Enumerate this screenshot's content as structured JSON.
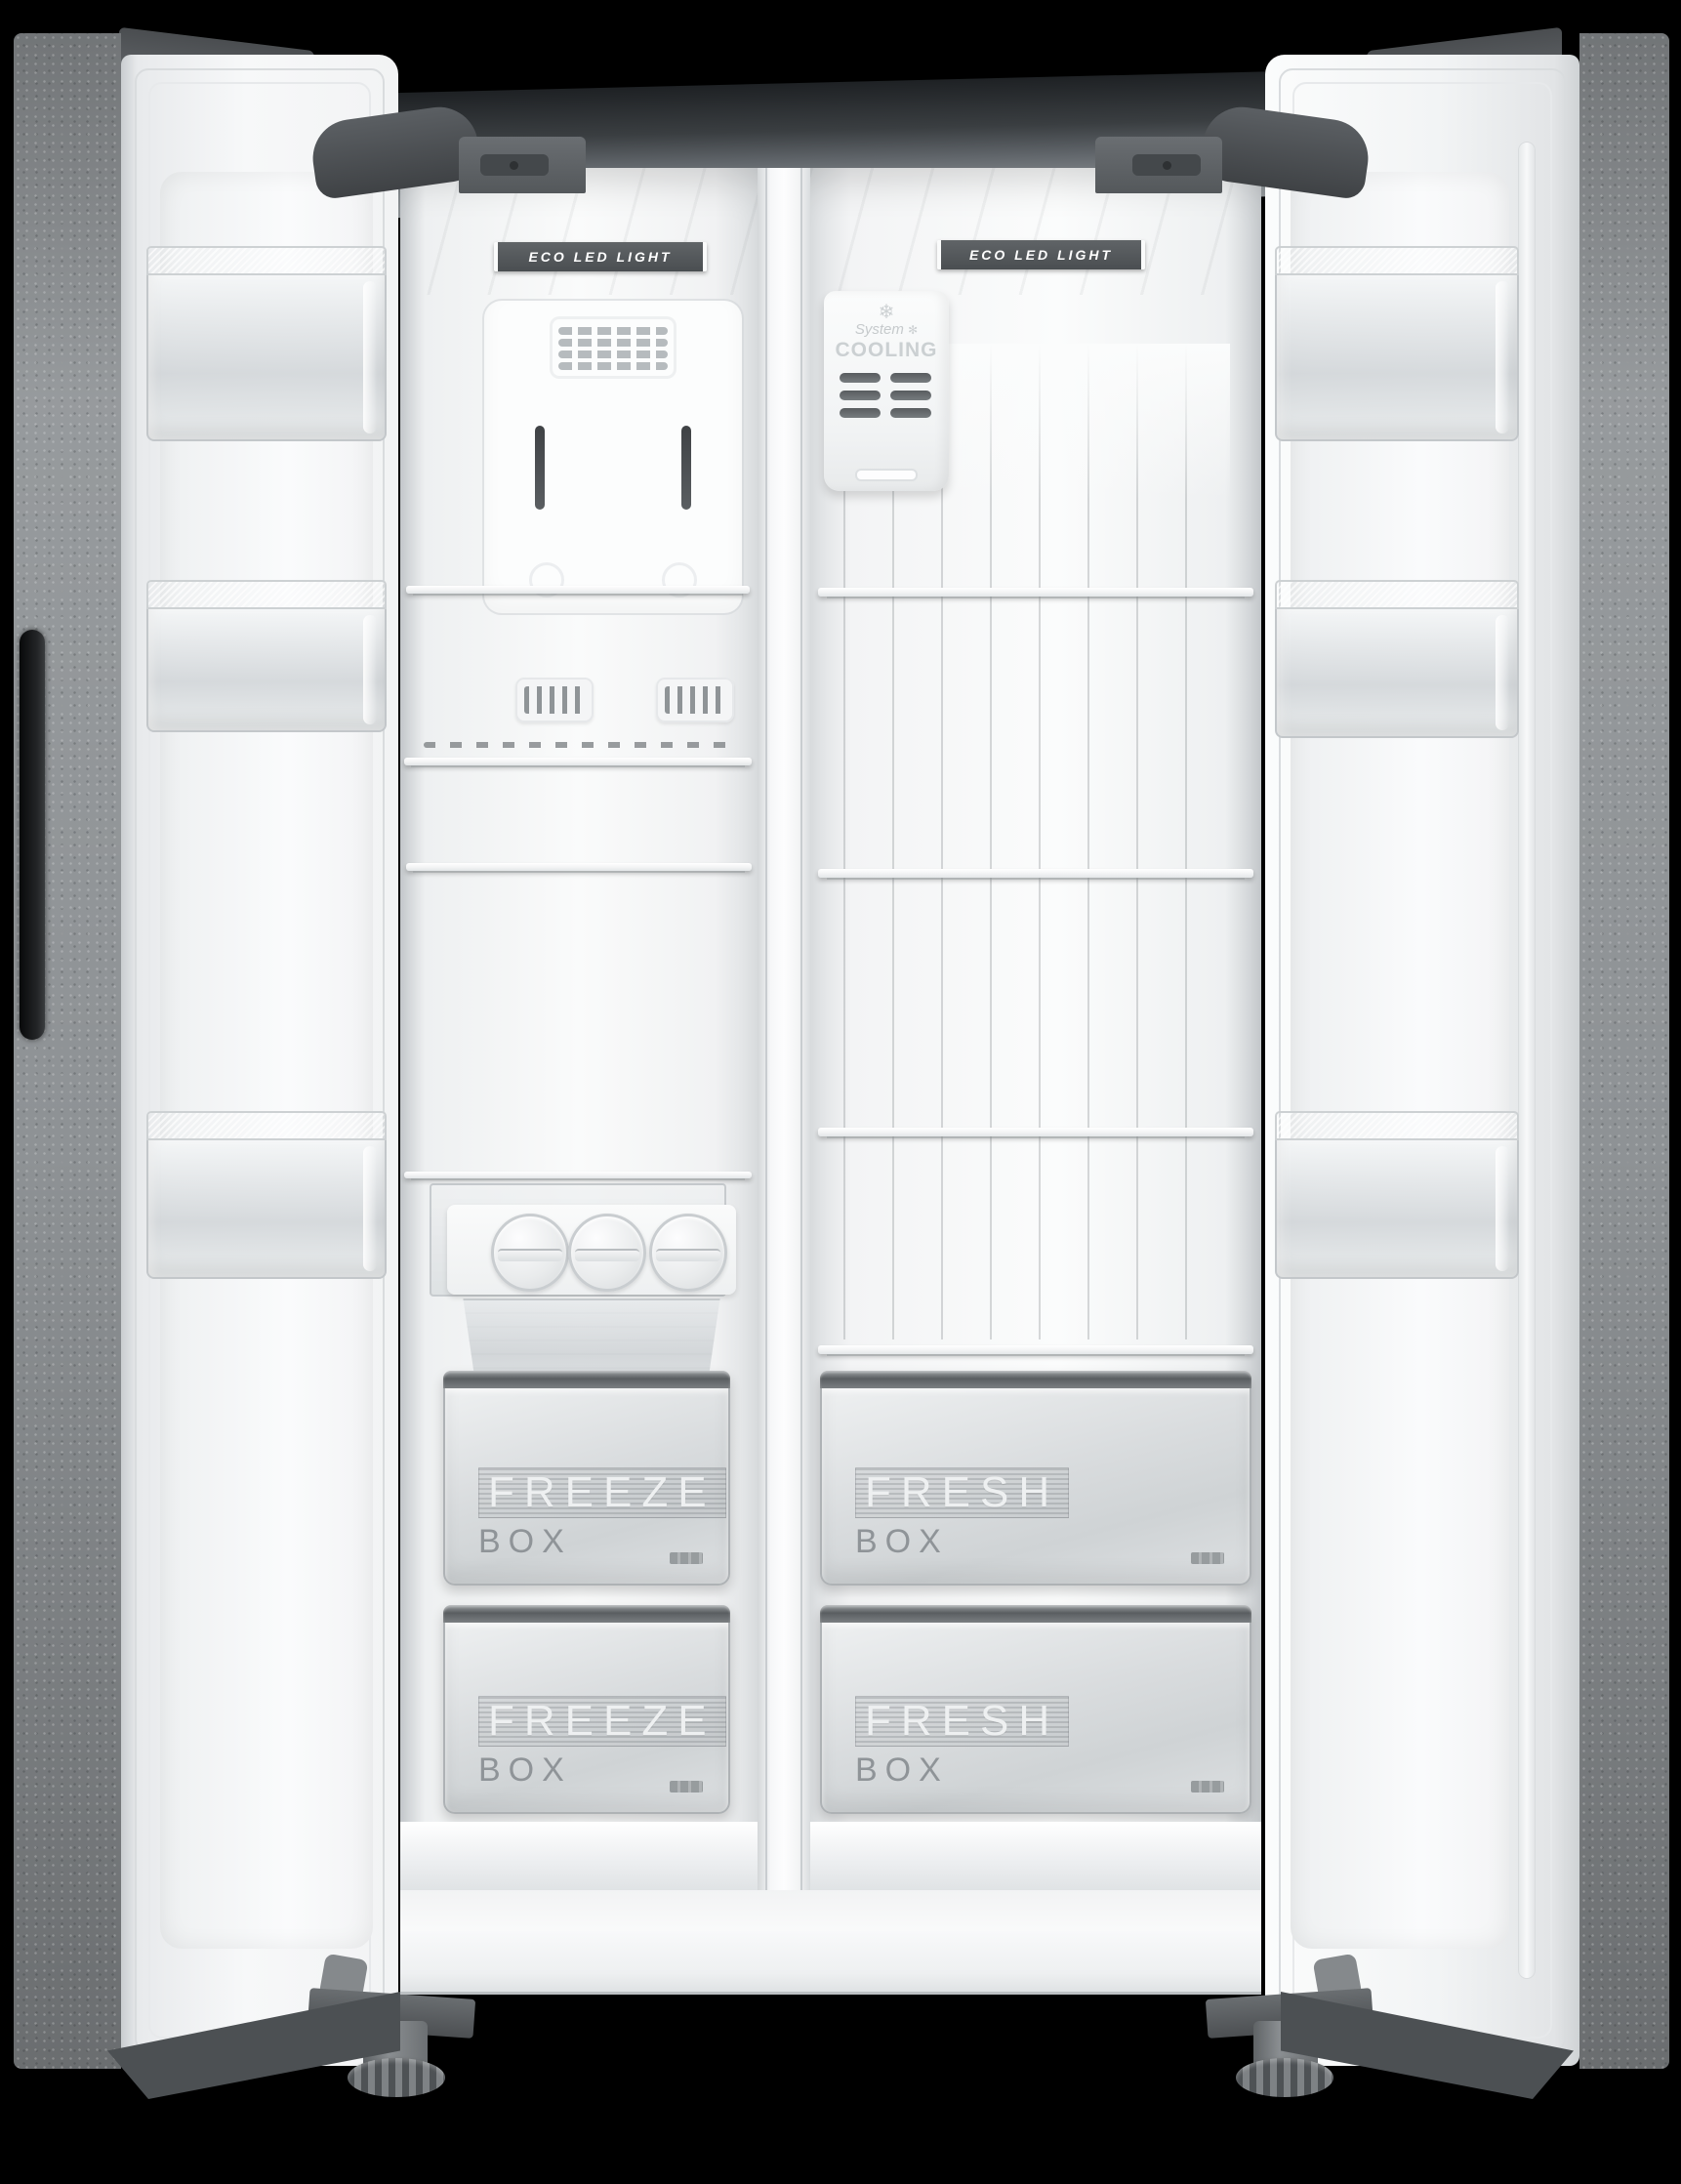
{
  "scene": {
    "description": "Side-by-side refrigerator with both doors open on black background"
  },
  "colors": {
    "background": "#000000",
    "cabinet_top": "#5a5e62",
    "door_exterior": "#8e9295",
    "interior_white": "#f5f6f7",
    "led_strip_background": "#515558",
    "led_strip_text": "#ffffff",
    "drawer_body": "#d6d9db",
    "drawer_rail": "#5a5e61",
    "label_gray": "#8f9498"
  },
  "freezer": {
    "led_label": "ECO LED LIGHT",
    "drawers": [
      {
        "title": "FREEZE",
        "subtitle": "BOX"
      },
      {
        "title": "FREEZE",
        "subtitle": "BOX"
      }
    ]
  },
  "fridge": {
    "led_label": "ECO LED LIGHT",
    "cooling_unit": {
      "snowflake": "❄",
      "line1": "System",
      "sparkle": "✻",
      "line2": "COOLING"
    },
    "drawers": [
      {
        "title": "FRESH",
        "subtitle": "BOX"
      },
      {
        "title": "FRESH",
        "subtitle": "BOX"
      }
    ]
  }
}
